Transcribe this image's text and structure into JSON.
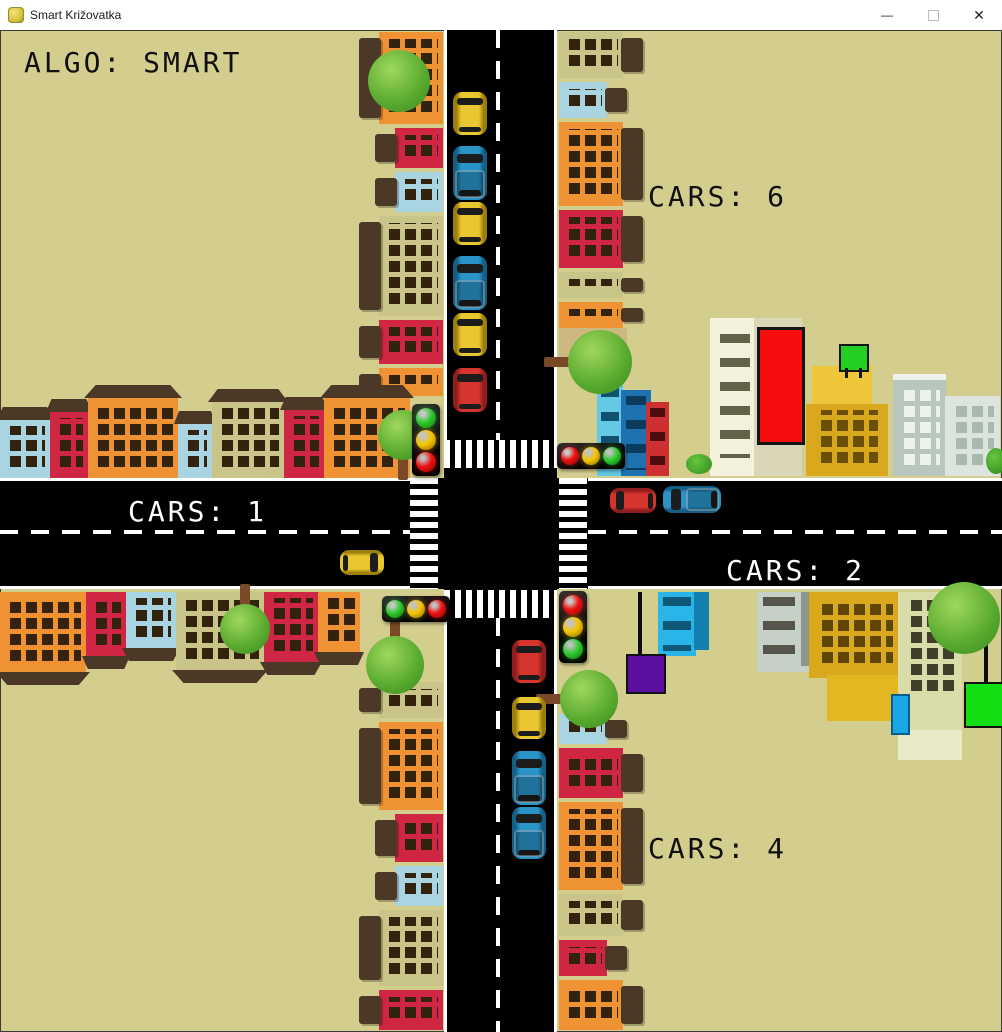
{
  "window": {
    "title": "Smart Križovatka",
    "controls": {
      "minimize": "—",
      "close": "✕"
    }
  },
  "hud": {
    "algo": "ALGO: SMART",
    "cars_north": "CARS: 6",
    "cars_west": "CARS: 1",
    "cars_east": "CARS: 2",
    "cars_south": "CARS: 4"
  },
  "scene": {
    "background": "#d3cd8e",
    "road_color": "#000000",
    "lamp_colors": {
      "red": {
        "c": "#f01212",
        "d": "#7c0404"
      },
      "yellow": {
        "c": "#f7c500",
        "d": "#8a6d00"
      },
      "green": {
        "c": "#2ecc2e",
        "d": "#0f6e0f"
      }
    },
    "house_palette": {
      "orange": "#ef9233",
      "red": "#cf2743",
      "blue": "#a9d4e2",
      "olive": "#c9c488",
      "roof": "#4c3826",
      "window": "#33220e"
    },
    "traffic_lights": [
      {
        "id": "nw",
        "orient": "v",
        "x": 412,
        "y": 374,
        "lamps": [
          "green",
          "yellow",
          "red"
        ]
      },
      {
        "id": "ne",
        "orient": "h",
        "x": 557,
        "y": 413,
        "lamps": [
          "red",
          "yellow",
          "green"
        ]
      },
      {
        "id": "sw",
        "orient": "h",
        "x": 382,
        "y": 566,
        "lamps": [
          "green",
          "yellow",
          "red"
        ]
      },
      {
        "id": "se",
        "orient": "v",
        "x": 559,
        "y": 561,
        "lamps": [
          "red",
          "yellow",
          "green"
        ]
      }
    ],
    "vehicles": [
      {
        "kind": "car",
        "color": "#e9c730",
        "shade": "#9c7e0a",
        "dir": "s",
        "x": 453,
        "y": 62,
        "w": 34,
        "h": 43
      },
      {
        "kind": "truck",
        "color": "#2a93c7",
        "shade": "#135f86",
        "dir": "s",
        "x": 453,
        "y": 116,
        "w": 34,
        "h": 54
      },
      {
        "kind": "car",
        "color": "#e9c730",
        "shade": "#9c7e0a",
        "dir": "s",
        "x": 453,
        "y": 172,
        "w": 34,
        "h": 43
      },
      {
        "kind": "truck",
        "color": "#2a93c7",
        "shade": "#135f86",
        "dir": "s",
        "x": 453,
        "y": 226,
        "w": 34,
        "h": 54
      },
      {
        "kind": "car",
        "color": "#e9c730",
        "shade": "#9c7e0a",
        "dir": "s",
        "x": 453,
        "y": 283,
        "w": 34,
        "h": 43
      },
      {
        "kind": "car",
        "color": "#d6342f",
        "shade": "#8f1d1d",
        "dir": "s",
        "x": 453,
        "y": 338,
        "w": 34,
        "h": 44
      },
      {
        "kind": "car",
        "color": "#e9c730",
        "shade": "#9c7e0a",
        "dir": "e",
        "x": 340,
        "y": 520,
        "w": 44,
        "h": 25
      },
      {
        "kind": "car",
        "color": "#d6342f",
        "shade": "#8f1d1d",
        "dir": "w",
        "x": 610,
        "y": 458,
        "w": 46,
        "h": 25
      },
      {
        "kind": "truck",
        "color": "#2a93c7",
        "shade": "#135f86",
        "dir": "w",
        "x": 663,
        "y": 456,
        "w": 58,
        "h": 27
      },
      {
        "kind": "car",
        "color": "#d6342f",
        "shade": "#8f1d1d",
        "dir": "n",
        "x": 512,
        "y": 610,
        "w": 34,
        "h": 43
      },
      {
        "kind": "car",
        "color": "#e9c730",
        "shade": "#9c7e0a",
        "dir": "n",
        "x": 512,
        "y": 667,
        "w": 34,
        "h": 42
      },
      {
        "kind": "truck",
        "color": "#2a93c7",
        "shade": "#135f86",
        "dir": "n",
        "x": 512,
        "y": 721,
        "w": 34,
        "h": 54
      },
      {
        "kind": "truck",
        "color": "#2a93c7",
        "shade": "#135f86",
        "dir": "n",
        "x": 512,
        "y": 777,
        "w": 34,
        "h": 52
      }
    ],
    "strips": [
      {
        "id": "nw",
        "x": 357,
        "y": 0,
        "h": 368,
        "side": "left",
        "seg": [
          [
            "orange",
            96
          ],
          [
            "red",
            44,
            1
          ],
          [
            "blue",
            44,
            1
          ],
          [
            "olive",
            104
          ],
          [
            "red",
            48
          ],
          [
            "orange",
            32
          ]
        ]
      },
      {
        "id": "ne",
        "x": 559,
        "y": 0,
        "h": 300,
        "side": "right",
        "seg": [
          [
            "olive",
            50
          ],
          [
            "blue",
            40,
            1
          ],
          [
            "orange",
            88
          ],
          [
            "red",
            62
          ],
          [
            "olive",
            30
          ],
          [
            "orange",
            30
          ]
        ]
      },
      {
        "id": "sw",
        "x": 357,
        "y": 650,
        "h": 352,
        "side": "left",
        "seg": [
          [
            "olive",
            40
          ],
          [
            "orange",
            92
          ],
          [
            "red",
            52,
            1
          ],
          [
            "blue",
            44,
            1
          ],
          [
            "olive",
            80
          ],
          [
            "red",
            44
          ]
        ]
      },
      {
        "id": "se",
        "x": 559,
        "y": 682,
        "h": 320,
        "side": "right",
        "seg": [
          [
            "blue",
            34,
            1
          ],
          [
            "red",
            54
          ],
          [
            "orange",
            92
          ],
          [
            "olive",
            46
          ],
          [
            "red",
            40,
            1
          ],
          [
            "orange",
            54
          ]
        ]
      }
    ],
    "rows": [
      {
        "id": "nw",
        "x": 0,
        "top": 351,
        "height": 97,
        "flip": false,
        "houses": [
          [
            "blue",
            50,
            58
          ],
          [
            "red",
            38,
            66
          ],
          [
            "orange",
            90,
            80
          ],
          [
            "blue",
            34,
            54
          ],
          [
            "olive",
            72,
            76
          ],
          [
            "red",
            40,
            68
          ],
          [
            "orange",
            86,
            80
          ]
        ]
      },
      {
        "id": "sw",
        "x": 0,
        "top": 562,
        "height": 97,
        "flip": true,
        "houses": [
          [
            "orange",
            86,
            80
          ],
          [
            "red",
            40,
            64
          ],
          [
            "blue",
            50,
            56
          ],
          [
            "olive",
            88,
            78
          ],
          [
            "red",
            54,
            70
          ],
          [
            "orange",
            42,
            60
          ]
        ]
      }
    ],
    "trees": [
      {
        "x": 368,
        "y": 20,
        "d": 62
      },
      {
        "x": 378,
        "y": 380,
        "d": 50,
        "trunk": "down"
      },
      {
        "x": 220,
        "y": 574,
        "d": 50,
        "trunk": "up"
      },
      {
        "x": 366,
        "y": 606,
        "d": 58,
        "trunk": "up"
      },
      {
        "x": 568,
        "y": 300,
        "d": 64,
        "trunk": "left"
      },
      {
        "x": 928,
        "y": 552,
        "d": 72
      },
      {
        "x": 560,
        "y": 640,
        "d": 58,
        "trunk": "left"
      }
    ]
  }
}
